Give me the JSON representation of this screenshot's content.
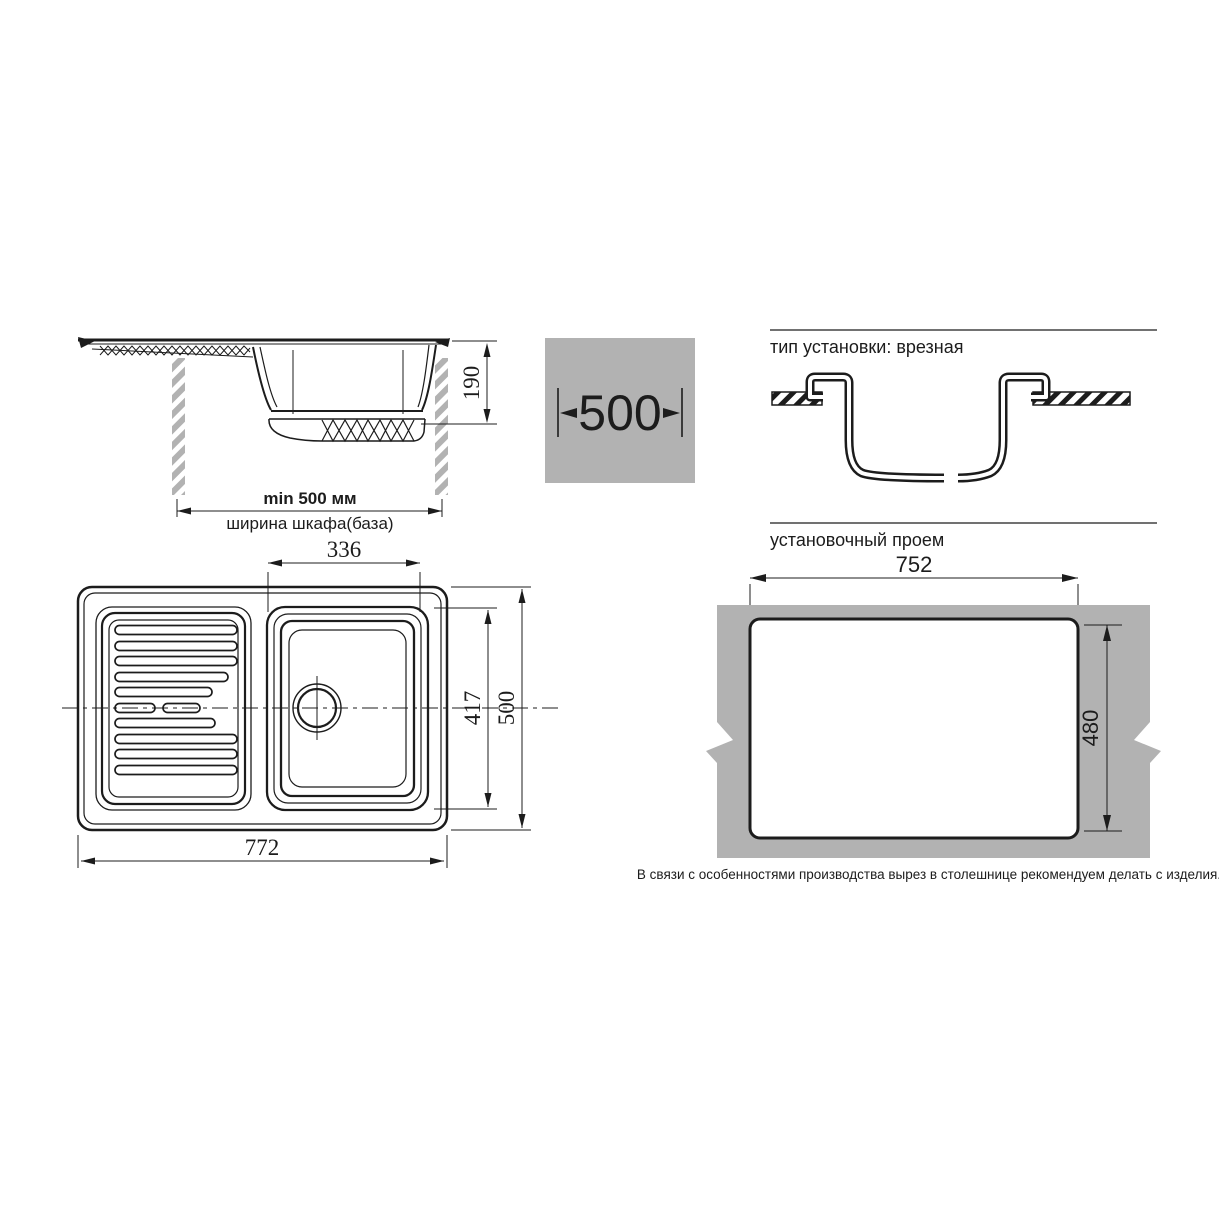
{
  "colors": {
    "ink": "#1c1c1c",
    "panel_gray": "#b2b2b2"
  },
  "side_view": {
    "depth_dim": "190",
    "cabinet_min_width": "min 500 мм",
    "cabinet_width_label": "ширина шкафа(база)"
  },
  "width_badge": {
    "value": "500"
  },
  "install_type": {
    "heading": "тип установки: врезная"
  },
  "cutout": {
    "heading": "установочный проем",
    "width_dim": "752",
    "height_dim": "480",
    "note": "В связи с особенностями производства вырез в столешнице рекомендуем делать с изделия."
  },
  "top_view": {
    "bowl_width_dim": "336",
    "bowl_depth_dim": "417",
    "overall_depth_dim": "500",
    "overall_width_dim": "772"
  }
}
